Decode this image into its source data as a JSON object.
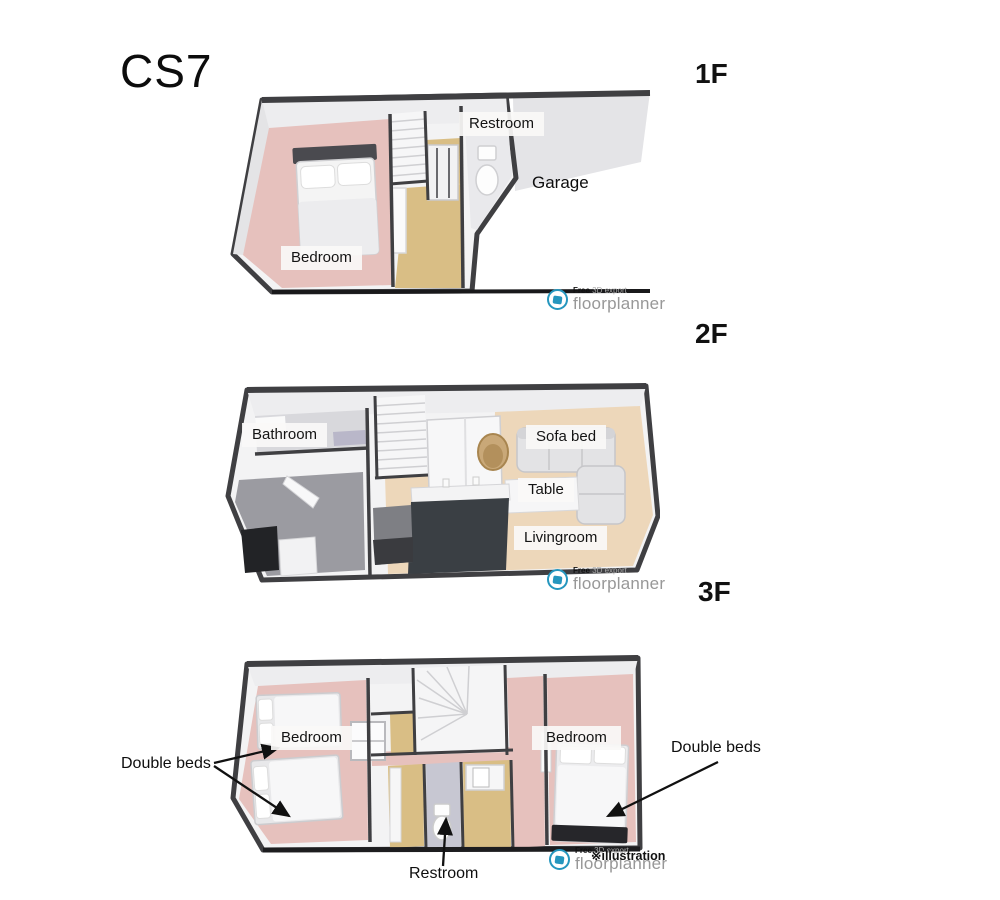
{
  "title": "CS7",
  "floors": [
    {
      "label": "1F",
      "rooms": {
        "restroom": "Restroom",
        "garage": "Garage",
        "bedroom": "Bedroom"
      }
    },
    {
      "label": "2F",
      "rooms": {
        "bathroom": "Bathroom",
        "sofa_bed": "Sofa bed",
        "table": "Table",
        "livingroom": "Livingroom"
      }
    },
    {
      "label": "3F",
      "rooms": {
        "bedroom_left": "Bedroom",
        "bedroom_right": "Bedroom"
      },
      "annotations": {
        "double_beds_left": "Double beds",
        "double_beds_right": "Double beds",
        "restroom_pointer": "Restroom"
      }
    }
  ],
  "watermark": {
    "brand": "floorplanner",
    "free_label": "Free",
    "export_label": "3D export",
    "illustration_label": "※illustration"
  },
  "colors": {
    "brand_blue": "#2596be",
    "wall_dark": "#3f3f42",
    "floor_pink": "#e6c1bd",
    "floor_tan": "#d9be85",
    "floor_cream": "#edd7ba",
    "floor_garage": "#e4e4e7",
    "bath_gray": "#d8d8dc",
    "room_gray": "#9b9ba1",
    "counter_dark": "#3a3f44"
  }
}
